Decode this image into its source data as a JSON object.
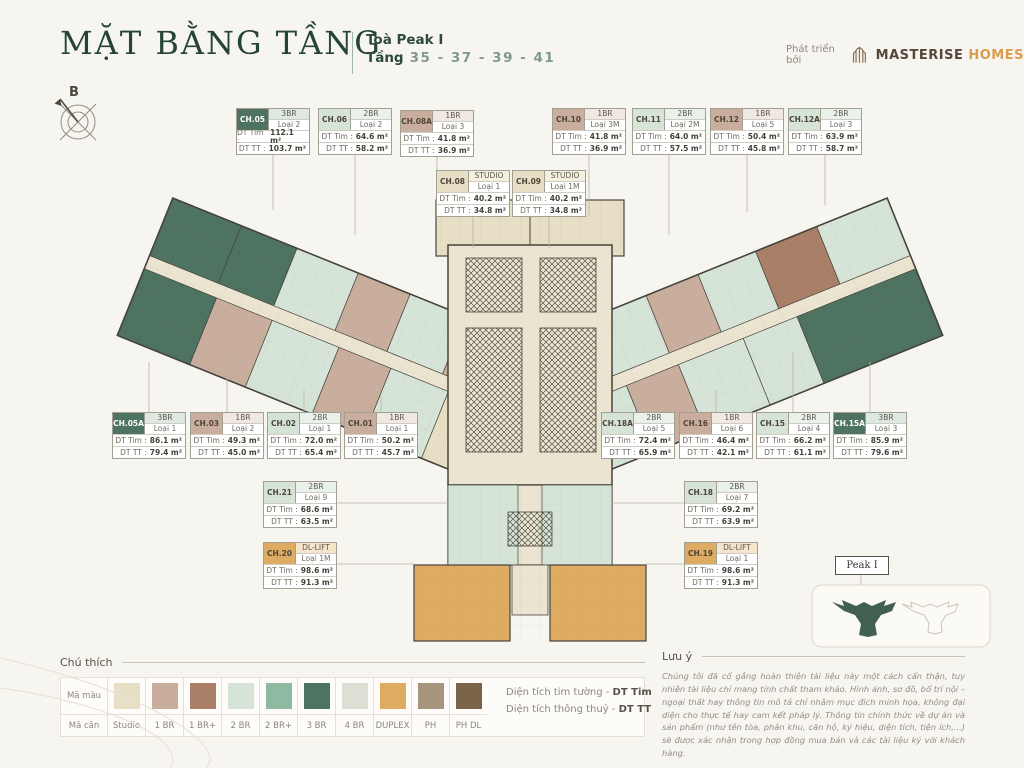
{
  "header": {
    "title": "MẶT BẰNG TẦNG",
    "tower": "Toà Peak I",
    "floor_label": "Tầng",
    "floors": "35 - 37 - 39 - 41",
    "developer_prefix": "Phát triển bởi",
    "brand_primary": "MASTERISE",
    "brand_secondary": "HOMES"
  },
  "compass": {
    "label": "B"
  },
  "labels": {
    "tim": "DT Tim :",
    "tt": "DT TT :"
  },
  "units": [
    {
      "code": "CH.05",
      "bed": "3BR",
      "loai": "Loại 2",
      "dt_tim": "112.1 m²",
      "dt_tt": "103.7 m²",
      "color": "3br",
      "x": 236,
      "y": 108
    },
    {
      "code": "CH.06",
      "bed": "2BR",
      "loai": "Loại 2",
      "dt_tim": "64.6 m²",
      "dt_tt": "58.2 m²",
      "color": "2br",
      "x": 318,
      "y": 108
    },
    {
      "code": "CH.08A",
      "bed": "1BR",
      "loai": "Loại 3",
      "dt_tim": "41.8 m²",
      "dt_tt": "36.9 m²",
      "color": "1br",
      "x": 400,
      "y": 110
    },
    {
      "code": "CH.10",
      "bed": "1BR",
      "loai": "Loại 3M",
      "dt_tim": "41.8 m²",
      "dt_tt": "36.9 m²",
      "color": "1br",
      "x": 552,
      "y": 108
    },
    {
      "code": "CH.11",
      "bed": "2BR",
      "loai": "Loại 2M",
      "dt_tim": "64.0 m²",
      "dt_tt": "57.5 m²",
      "color": "2br",
      "x": 632,
      "y": 108
    },
    {
      "code": "CH.12",
      "bed": "1BR",
      "loai": "Loại 5",
      "dt_tim": "50.4 m²",
      "dt_tt": "45.8 m²",
      "color": "1br",
      "x": 710,
      "y": 108
    },
    {
      "code": "CH.12A",
      "bed": "2BR",
      "loai": "Loại 3",
      "dt_tim": "63.9 m²",
      "dt_tt": "58.7 m²",
      "color": "2br",
      "x": 788,
      "y": 108
    },
    {
      "code": "CH.08",
      "bed": "STUDIO",
      "loai": "Loại 1",
      "dt_tim": "40.2 m²",
      "dt_tt": "34.8 m²",
      "color": "studio",
      "x": 436,
      "y": 170
    },
    {
      "code": "CH.09",
      "bed": "STUDIO",
      "loai": "Loại 1M",
      "dt_tim": "40.2 m²",
      "dt_tt": "34.8 m²",
      "color": "studio",
      "x": 512,
      "y": 170
    },
    {
      "code": "CH.05A",
      "bed": "3BR",
      "loai": "Loại 1",
      "dt_tim": "86.1 m²",
      "dt_tt": "79.4 m²",
      "color": "3br",
      "x": 112,
      "y": 412
    },
    {
      "code": "CH.03",
      "bed": "1BR",
      "loai": "Loại 2",
      "dt_tim": "49.3 m²",
      "dt_tt": "45.0 m²",
      "color": "1br",
      "x": 190,
      "y": 412
    },
    {
      "code": "CH.02",
      "bed": "2BR",
      "loai": "Loại 1",
      "dt_tim": "72.0 m²",
      "dt_tt": "65.4 m²",
      "color": "2br",
      "x": 267,
      "y": 412
    },
    {
      "code": "CH.01",
      "bed": "1BR",
      "loai": "Loại 1",
      "dt_tim": "50.2 m²",
      "dt_tt": "45.7 m²",
      "color": "1br",
      "x": 344,
      "y": 412
    },
    {
      "code": "CH.18A",
      "bed": "2BR",
      "loai": "Loại 5",
      "dt_tim": "72.4 m²",
      "dt_tt": "65.9 m²",
      "color": "2br",
      "x": 601,
      "y": 412
    },
    {
      "code": "CH.16",
      "bed": "1BR",
      "loai": "Loại 6",
      "dt_tim": "46.4 m²",
      "dt_tt": "42.1 m²",
      "color": "1br",
      "x": 679,
      "y": 412
    },
    {
      "code": "CH.15",
      "bed": "2BR",
      "loai": "Loại 4",
      "dt_tim": "66.2 m²",
      "dt_tt": "61.1 m²",
      "color": "2br",
      "x": 756,
      "y": 412
    },
    {
      "code": "CH.15A",
      "bed": "3BR",
      "loai": "Loại 3",
      "dt_tim": "85.9 m²",
      "dt_tt": "79.6 m²",
      "color": "3br",
      "x": 833,
      "y": 412
    },
    {
      "code": "CH.21",
      "bed": "2BR",
      "loai": "Loại 9",
      "dt_tim": "68.6 m²",
      "dt_tt": "63.5 m²",
      "color": "2br",
      "x": 263,
      "y": 481
    },
    {
      "code": "CH.18",
      "bed": "2BR",
      "loai": "Loại 7",
      "dt_tim": "69.2 m²",
      "dt_tt": "63.9 m²",
      "color": "2br",
      "x": 684,
      "y": 481
    },
    {
      "code": "CH.20",
      "bed": "DL-LIFT",
      "loai": "Loại 1M",
      "dt_tim": "98.6 m²",
      "dt_tt": "91.3 m²",
      "color": "duplex",
      "x": 263,
      "y": 542
    },
    {
      "code": "CH.19",
      "bed": "DL-LIFT",
      "loai": "Loại 1",
      "dt_tim": "98.6 m²",
      "dt_tt": "91.3 m²",
      "color": "duplex",
      "x": 684,
      "y": 542
    }
  ],
  "legend": {
    "title": "Chú thích",
    "row_color_label": "Mã màu",
    "row_code_label": "Mã căn",
    "items": [
      {
        "label": "Studio",
        "color": "#e6dfc6"
      },
      {
        "label": "1 BR",
        "color": "#c9ae9e"
      },
      {
        "label": "1 BR+",
        "color": "#a97f68"
      },
      {
        "label": "2 BR",
        "color": "#d6e4d7"
      },
      {
        "label": "2 BR+",
        "color": "#8fbaa2"
      },
      {
        "label": "3 BR",
        "color": "#4e7360"
      },
      {
        "label": "4 BR",
        "color": "#deded4"
      },
      {
        "label": "DUPLEX",
        "color": "#ddab62"
      },
      {
        "label": "PH",
        "color": "#a6947f"
      },
      {
        "label": "PH DL",
        "color": "#7b6349"
      }
    ]
  },
  "area_definitions": [
    {
      "label": "Diện tích tim tường",
      "abbr": "DT Tim"
    },
    {
      "label": "Diện tích thông thuỷ",
      "abbr": "DT TT"
    }
  ],
  "note": {
    "title": "Lưu ý",
    "text": "Chúng tôi đã cố gắng hoàn thiện tài liệu này một cách cẩn thận, tuy nhiên tài liệu chỉ mang tính chất tham khảo. Hình ảnh, sơ đồ, bố trí nội – ngoại thất hay thông tin mô tả chỉ nhằm mục đích minh họa, không đại diện cho thực tế hay cam kết pháp lý. Thông tin chính thức về dự án và sản phẩm (như tên tòa, phân khu, căn hộ, ký hiệu, diện tích, tiện ích,...) sẽ được xác nhận trong hợp đồng mua bán và các tài liệu ký với khách hàng."
  },
  "minimap": {
    "label": "Peak I"
  },
  "colors": {
    "3br": "#4e7360",
    "2br": "#d6e4d7",
    "1br": "#c9ae9e",
    "studio": "#e6dfc6",
    "duplex": "#ddab62",
    "tint_3br": "#dde8e0",
    "tint_2br": "#e9f1ea",
    "tint_1br": "#f0e8e2",
    "tint_studio": "#f4efdf",
    "tint_duplex": "#f5e6cb"
  }
}
